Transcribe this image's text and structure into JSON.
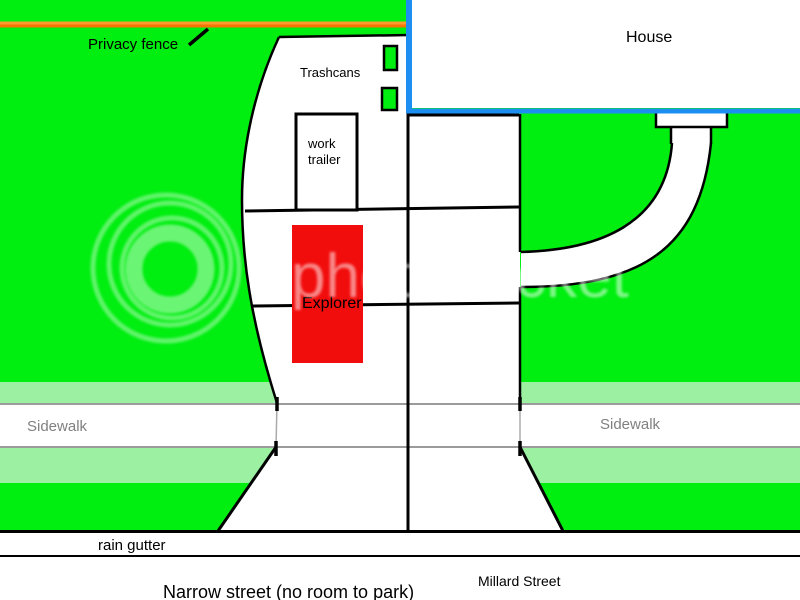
{
  "labels": {
    "privacy_fence": "Privacy fence",
    "trashcans": "Trashcans",
    "work_trailer_line1": "work",
    "work_trailer_line2": "trailer",
    "explorer": "Explorer",
    "house": "House",
    "sidewalk_left": "Sidewalk",
    "sidewalk_right": "Sidewalk",
    "rain_gutter": "rain gutter",
    "narrow_street": "Narrow street (no room to park)",
    "millard_street": "Millard Street"
  },
  "watermark": {
    "text": "photobucket"
  },
  "colors": {
    "lawn_green": "#00EE10",
    "grass_light_green": "#9BF0A2",
    "fence_orange_top": "#FF9A2E",
    "fence_orange_bottom": "#F57404",
    "house_border_blue": "#1E8FF2",
    "explorer_red": "#F20D0D",
    "trashcan_green": "#00EE10",
    "outline_black": "#000000",
    "sidewalk_line_gray": "#9B9B9B",
    "label_gray": "#808080",
    "surface_white": "#FFFFFF",
    "watermark_white": "#FFFFFF"
  }
}
